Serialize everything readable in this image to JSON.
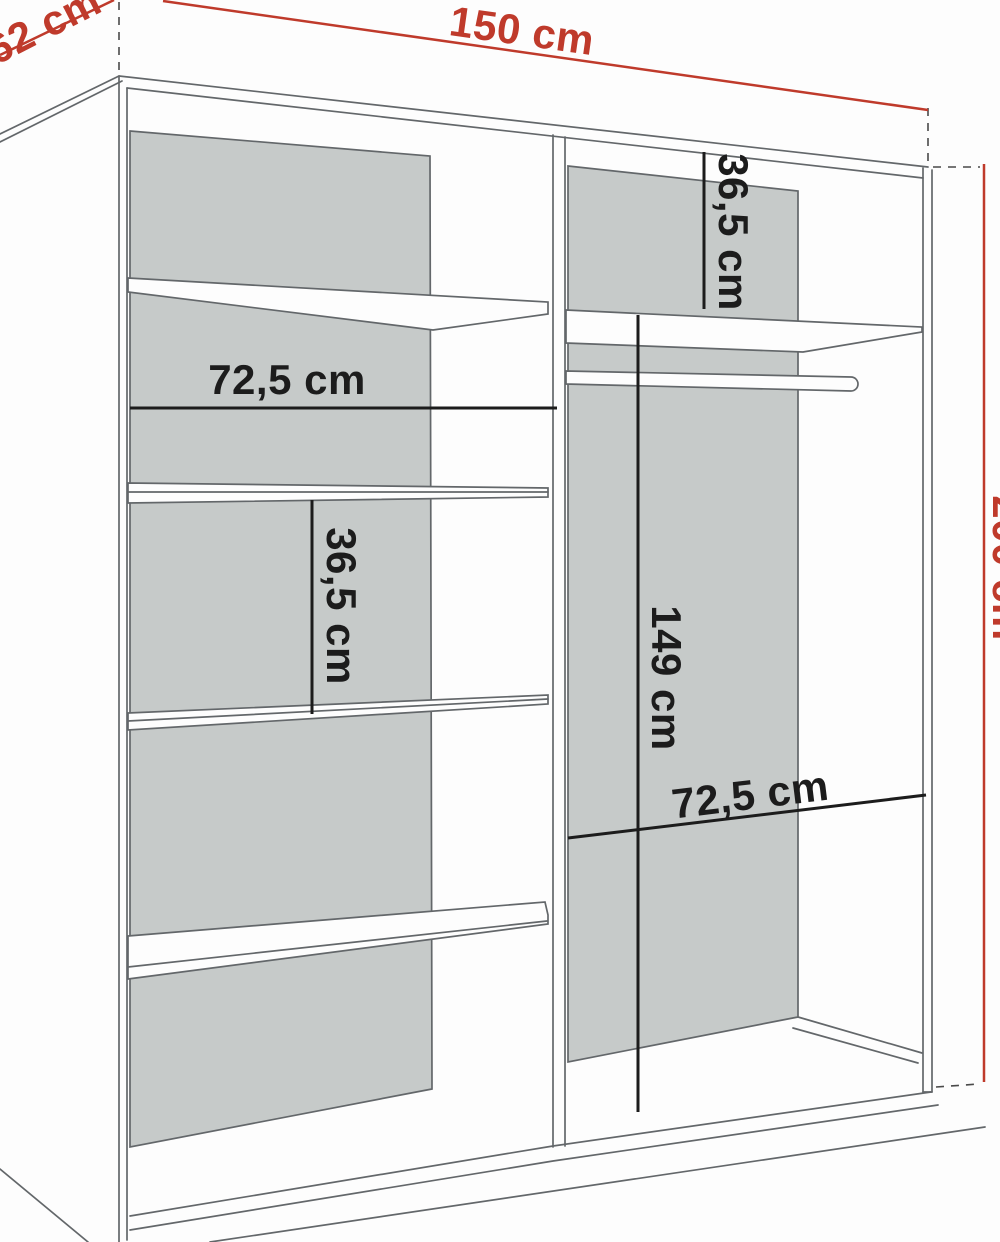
{
  "dimensions": {
    "overall_width": {
      "label": "150 cm"
    },
    "depth": {
      "label": "62 cm"
    },
    "overall_height": {
      "label": "200 cm"
    },
    "left_section_width": {
      "label": "72,5 cm"
    },
    "left_shelf_spacing": {
      "label": "36,5 cm"
    },
    "right_top_shelf_offset": {
      "label": "36,5 cm"
    },
    "hanging_space_height": {
      "label": "149 cm"
    },
    "right_section_width": {
      "label": "72,5 cm"
    }
  },
  "colors": {
    "dimension_red": "#bf3a2b",
    "dimension_black": "#1c1c1c",
    "panel_gray": "#c6cac9",
    "cabinet_outline": "#63676a",
    "shelf_white": "#fdfdfd"
  }
}
